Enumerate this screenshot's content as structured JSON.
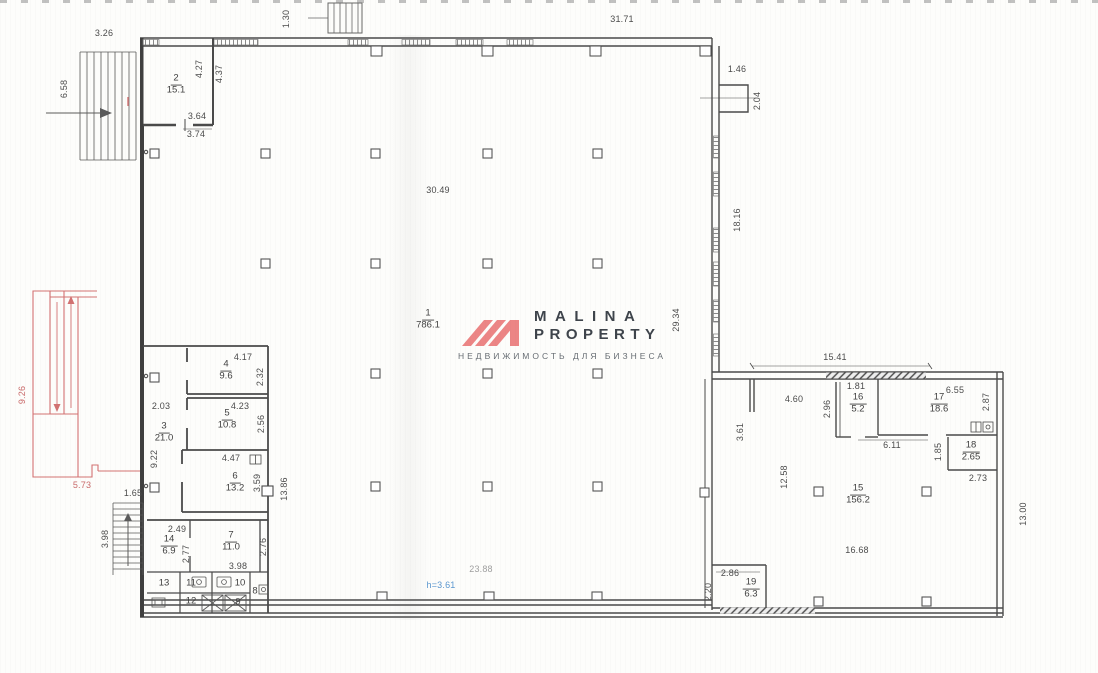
{
  "logo": {
    "line1": "MALINA",
    "line2": "PROPERTY",
    "tagline": "НЕДВИЖИМОСТЬ ДЛЯ БИЗНЕСА",
    "colors": {
      "mark": "#ec8585",
      "text": "#3e444b",
      "tagline": "#676d73"
    }
  },
  "labels": {
    "dims": [
      {
        "t": "3.26",
        "x": 104,
        "y": 33
      },
      {
        "t": "6.58",
        "x": 64,
        "y": 89,
        "r": 1
      },
      {
        "t": "1.30",
        "x": 286,
        "y": 19,
        "r": 1
      },
      {
        "t": "31.71",
        "x": 622,
        "y": 19
      },
      {
        "t": "1.46",
        "x": 737,
        "y": 69
      },
      {
        "t": "2.04",
        "x": 757,
        "y": 101,
        "r": 1
      },
      {
        "t": "18.16",
        "x": 737,
        "y": 220,
        "r": 1
      },
      {
        "t": "29.34",
        "x": 676,
        "y": 320,
        "r": 1
      },
      {
        "t": "30.49",
        "x": 438,
        "y": 190
      },
      {
        "t": "4.27",
        "x": 199,
        "y": 69,
        "r": 1
      },
      {
        "t": "4.37",
        "x": 219,
        "y": 74,
        "r": 1
      },
      {
        "t": "3.64",
        "x": 197,
        "y": 116
      },
      {
        "t": "3.74",
        "x": 196,
        "y": 134
      },
      {
        "t": "2.03",
        "x": 161,
        "y": 406
      },
      {
        "t": "9.22",
        "x": 154,
        "y": 459,
        "r": 1
      },
      {
        "t": "4.17",
        "x": 243,
        "y": 357
      },
      {
        "t": "2.32",
        "x": 260,
        "y": 377,
        "r": 1
      },
      {
        "t": "4.23",
        "x": 240,
        "y": 406
      },
      {
        "t": "2.56",
        "x": 261,
        "y": 424,
        "r": 1
      },
      {
        "t": "4.47",
        "x": 231,
        "y": 458
      },
      {
        "t": "3.59",
        "x": 257,
        "y": 483,
        "r": 1
      },
      {
        "t": "13.86",
        "x": 284,
        "y": 489,
        "r": 1
      },
      {
        "t": "9.26",
        "x": 22,
        "y": 395,
        "r": 1,
        "c": "red"
      },
      {
        "t": "5.73",
        "x": 82,
        "y": 485,
        "c": "red"
      },
      {
        "t": "1.65",
        "x": 133,
        "y": 493
      },
      {
        "t": "3.98",
        "x": 105,
        "y": 539,
        "r": 1
      },
      {
        "t": "2.49",
        "x": 177,
        "y": 529
      },
      {
        "t": "2.77",
        "x": 186,
        "y": 554,
        "r": 1
      },
      {
        "t": "2.76",
        "x": 263,
        "y": 547,
        "r": 1
      },
      {
        "t": "3.98",
        "x": 238,
        "y": 566
      },
      {
        "t": "15.41",
        "x": 835,
        "y": 357
      },
      {
        "t": "4.60",
        "x": 794,
        "y": 399
      },
      {
        "t": "3.61",
        "x": 740,
        "y": 432,
        "r": 1
      },
      {
        "t": "1.81",
        "x": 856,
        "y": 386
      },
      {
        "t": "2.96",
        "x": 827,
        "y": 409,
        "r": 1
      },
      {
        "t": "6.55",
        "x": 955,
        "y": 390
      },
      {
        "t": "2.87",
        "x": 986,
        "y": 402,
        "r": 1
      },
      {
        "t": "6.11",
        "x": 892,
        "y": 445
      },
      {
        "t": "1.85",
        "x": 938,
        "y": 452,
        "r": 1
      },
      {
        "t": "2.73",
        "x": 978,
        "y": 478
      },
      {
        "t": "12.58",
        "x": 784,
        "y": 477,
        "r": 1
      },
      {
        "t": "16.68",
        "x": 857,
        "y": 550
      },
      {
        "t": "13.00",
        "x": 1023,
        "y": 514,
        "r": 1
      },
      {
        "t": "2.86",
        "x": 730,
        "y": 573
      },
      {
        "t": "2.20",
        "x": 708,
        "y": 592,
        "r": 1
      },
      {
        "t": "23.88",
        "x": 481,
        "y": 569,
        "c": "faint"
      },
      {
        "t": "h=3.61",
        "x": 441,
        "y": 585,
        "c": "blue"
      }
    ],
    "rooms": [
      {
        "num": "1",
        "area": "786.1",
        "x": 428,
        "y": 320
      },
      {
        "num": "2",
        "area": "15.1",
        "x": 176,
        "y": 85
      },
      {
        "num": "3",
        "area": "21.0",
        "x": 164,
        "y": 433
      },
      {
        "num": "4",
        "area": "9.6",
        "x": 226,
        "y": 371
      },
      {
        "num": "5",
        "area": "10.8",
        "x": 227,
        "y": 420
      },
      {
        "num": "6",
        "area": "13.2",
        "x": 235,
        "y": 483
      },
      {
        "num": "7",
        "area": "11.0",
        "x": 231,
        "y": 542
      },
      {
        "num": "14",
        "area": "6.9",
        "x": 169,
        "y": 546
      },
      {
        "num": "15",
        "area": "156.2",
        "x": 858,
        "y": 495
      },
      {
        "num": "16",
        "area": "5.2",
        "x": 858,
        "y": 404
      },
      {
        "num": "17",
        "area": "18.6",
        "x": 939,
        "y": 404
      },
      {
        "num": "18",
        "area": "2.65",
        "x": 971,
        "y": 452
      },
      {
        "num": "19",
        "area": "6.3",
        "x": 751,
        "y": 589
      }
    ],
    "cells": [
      {
        "t": "13",
        "x": 164,
        "y": 583
      },
      {
        "t": "11",
        "x": 191,
        "y": 583
      },
      {
        "t": "10",
        "x": 240,
        "y": 583
      },
      {
        "t": "8",
        "x": 255,
        "y": 591
      },
      {
        "t": "12",
        "x": 191,
        "y": 601
      },
      {
        "t": "9",
        "x": 238,
        "y": 602
      }
    ]
  }
}
